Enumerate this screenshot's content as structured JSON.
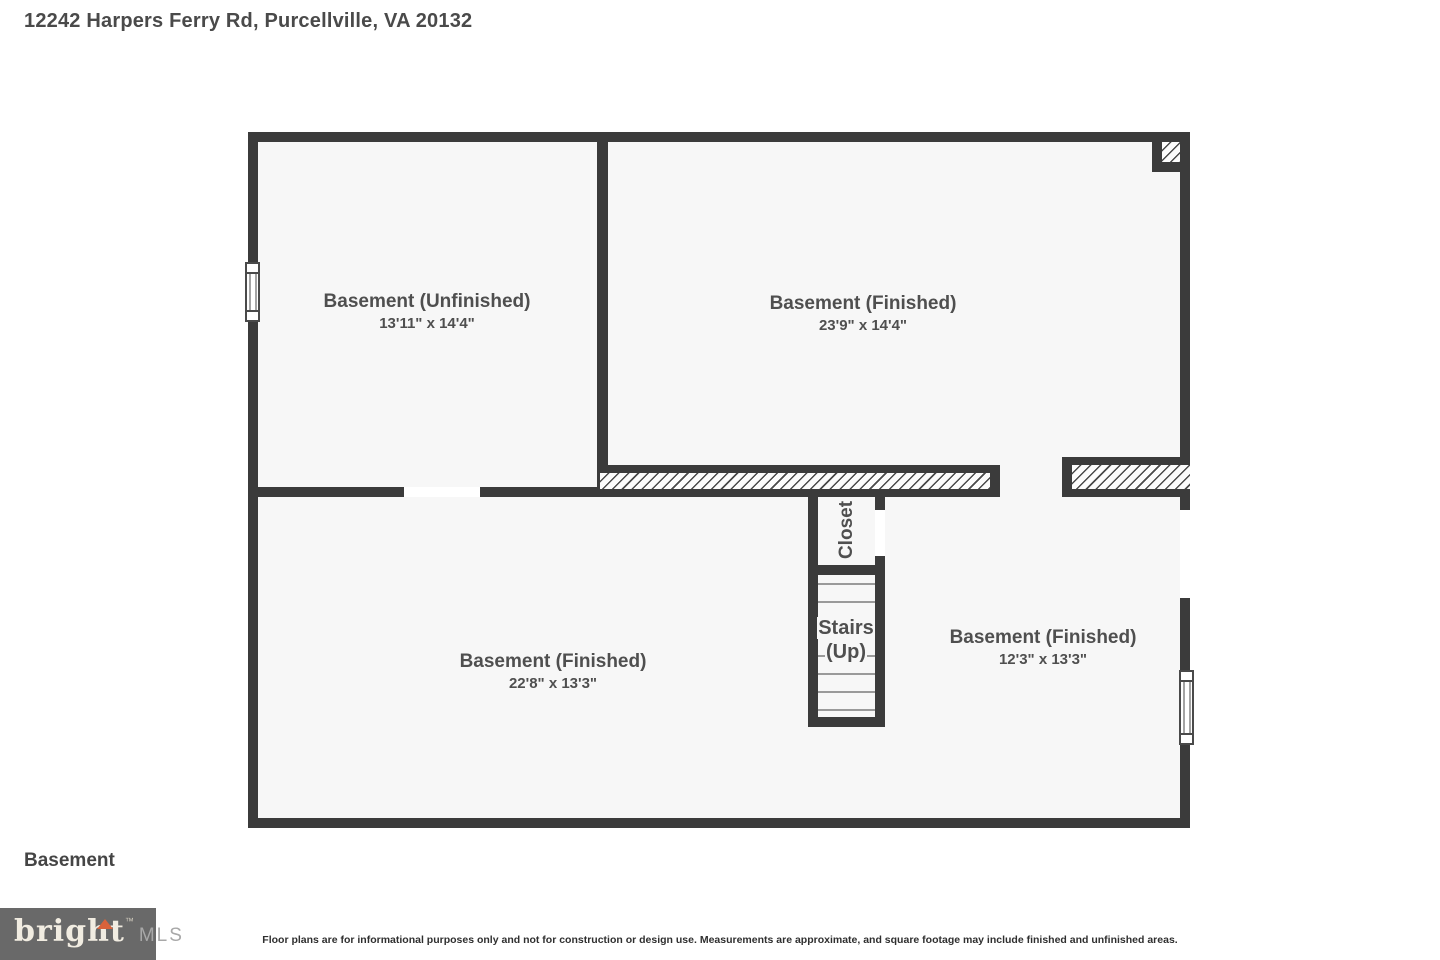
{
  "page": {
    "title": "12242 Harpers Ferry Rd, Purcellville, VA 20132",
    "floor_label": "Basement",
    "disclaimer": "Floor plans are for informational purposes only and not for construction or design use. Measurements are approximate, and square footage may include finished and unfinished areas."
  },
  "rooms": [
    {
      "name": "Basement (Unfinished)",
      "dims": "13'11\" x 14'4\""
    },
    {
      "name": "Basement (Finished)",
      "dims": "23'9\" x 14'4\""
    },
    {
      "name": "Basement (Finished)",
      "dims": "22'8\" x 13'3\""
    },
    {
      "name": "Basement (Finished)",
      "dims": "12'3\" x 13'3\""
    }
  ],
  "features": {
    "closet": "Closet",
    "stairs_line1": "Stairs",
    "stairs_line2": "(Up)"
  },
  "logo": {
    "brand": "bright",
    "tm": "™",
    "suffix": "MLS"
  },
  "colors": {
    "wall": "#3b3b3b",
    "floor": "#f7f7f7",
    "label": "#4f4f4f",
    "logo_bg": "#696969",
    "logo_arrow": "#d9623a"
  }
}
